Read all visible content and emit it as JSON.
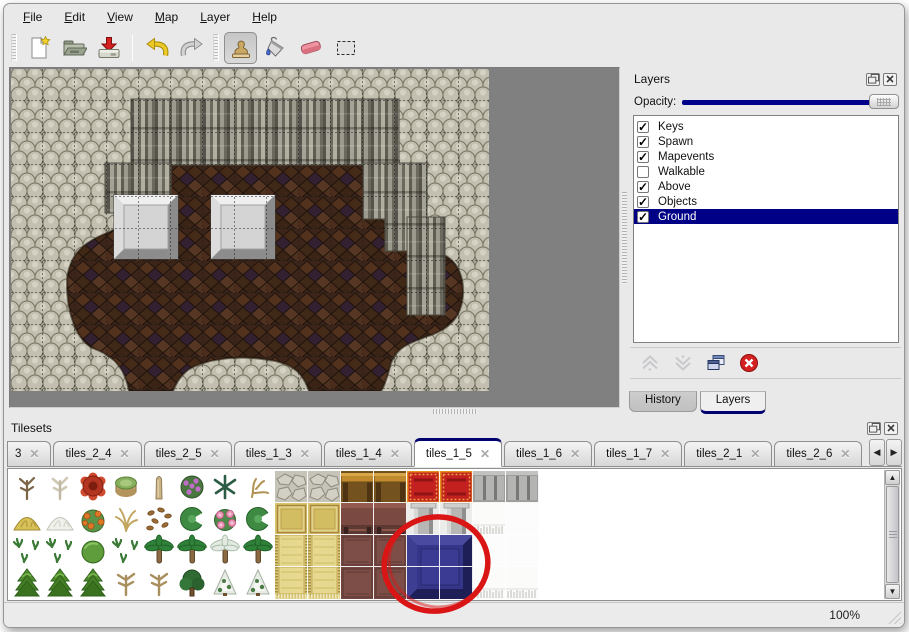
{
  "menu": {
    "items": [
      {
        "label": "File"
      },
      {
        "label": "Edit"
      },
      {
        "label": "View"
      },
      {
        "label": "Map"
      },
      {
        "label": "Layer"
      },
      {
        "label": "Help"
      }
    ]
  },
  "toolbar": {
    "buttons": [
      {
        "name": "new-file",
        "icon": "new-file-icon"
      },
      {
        "name": "open",
        "icon": "open-folder-icon"
      },
      {
        "name": "save",
        "icon": "save-icon"
      },
      {
        "name": "undo",
        "icon": "undo-arrow-icon"
      },
      {
        "name": "redo",
        "icon": "redo-arrow-icon"
      },
      {
        "name": "stamp",
        "icon": "stamp-icon",
        "active": true
      },
      {
        "name": "fill",
        "icon": "paint-bucket-icon"
      },
      {
        "name": "eraser",
        "icon": "eraser-icon"
      },
      {
        "name": "select",
        "icon": "selection-rect-icon"
      }
    ]
  },
  "layers_panel": {
    "title": "Layers",
    "opacity_label": "Opacity:",
    "opacity_slider_position": "full-right",
    "layers": [
      {
        "name": "Keys",
        "checked": true,
        "selected": false
      },
      {
        "name": "Spawn",
        "checked": true,
        "selected": false
      },
      {
        "name": "Mapevents",
        "checked": true,
        "selected": false
      },
      {
        "name": "Walkable",
        "checked": false,
        "selected": false
      },
      {
        "name": "Above",
        "checked": true,
        "selected": false
      },
      {
        "name": "Objects",
        "checked": true,
        "selected": false
      },
      {
        "name": "Ground",
        "checked": true,
        "selected": true
      }
    ],
    "buttons": [
      "move-layer-up",
      "move-layer-down",
      "duplicate-layer",
      "delete-layer"
    ],
    "tabs": [
      {
        "label": "History",
        "active": false
      },
      {
        "label": "Layers",
        "active": true
      }
    ]
  },
  "tilesets_panel": {
    "title": "Tilesets",
    "tabs": [
      {
        "label": "3",
        "partial": true,
        "active": false
      },
      {
        "label": "tiles_2_4",
        "active": false
      },
      {
        "label": "tiles_2_5",
        "active": false
      },
      {
        "label": "tiles_1_3",
        "active": false
      },
      {
        "label": "tiles_1_4",
        "active": false
      },
      {
        "label": "tiles_1_5",
        "active": true
      },
      {
        "label": "tiles_1_6",
        "active": false
      },
      {
        "label": "tiles_1_7",
        "active": false
      },
      {
        "label": "tiles_2_1",
        "active": false
      },
      {
        "label": "tiles_2_6",
        "active": false
      }
    ],
    "tile_grid": [
      [
        "tree-dead",
        "tree-dead-pale",
        "flower-red",
        "stump",
        "spire",
        "bush-purple",
        "fern",
        "twig",
        "stone-floor",
        "stone-floor",
        "table-gold",
        "table-gold",
        "carpet-red",
        "carpet-red",
        "stone-wall",
        "stone-wall"
      ],
      [
        "mound-yellow",
        "mound-white",
        "flowers-orange",
        "grass-dry",
        "leaves",
        "lilypad",
        "flower-pink",
        "lilypad",
        "gold-floor",
        "gold-floor",
        "maroon-chair",
        "maroon-chair",
        "pillar",
        "pillar",
        "white-fringe",
        "white-plain"
      ],
      [
        "sprouts",
        "sprouts",
        "bush-round",
        "sprouts",
        "palm",
        "palm",
        "palm-snowy",
        "palm",
        "gold-carpet",
        "gold-carpet",
        "maroon-tile",
        "maroon-tile",
        "blue-tile",
        "blue-tile",
        "white-plain",
        "white-plain"
      ],
      [
        "cone-tree",
        "cone-tree",
        "cone-tree",
        "tree-bare",
        "tree-bare",
        "tree-dark",
        "tree-snowy",
        "tree-snowy",
        "gold-carpet-fringe",
        "gold-carpet-fringe",
        "maroon-tile",
        "maroon-tile",
        "blue-tile",
        "blue-tile",
        "white-fringe",
        "white-fringe"
      ]
    ],
    "annotation": "red-circle-around-blue-tile"
  },
  "map": {
    "description": "cave map: gray rock border, ribbed cliff walls, brown cobble floor, two beveled platforms",
    "grid_overlay": true
  },
  "status_bar": {
    "zoom": "100%"
  },
  "colors": {
    "accent_navy": "#000080",
    "selection_highlight": "#000087",
    "annotation_red": "#da1515",
    "canvas_gray": "#808080",
    "floor_brown": "#3c2518",
    "rock_gray": "#aeab9d",
    "blue_tile": "#31317e",
    "eraser_pink": "#f093a0"
  }
}
